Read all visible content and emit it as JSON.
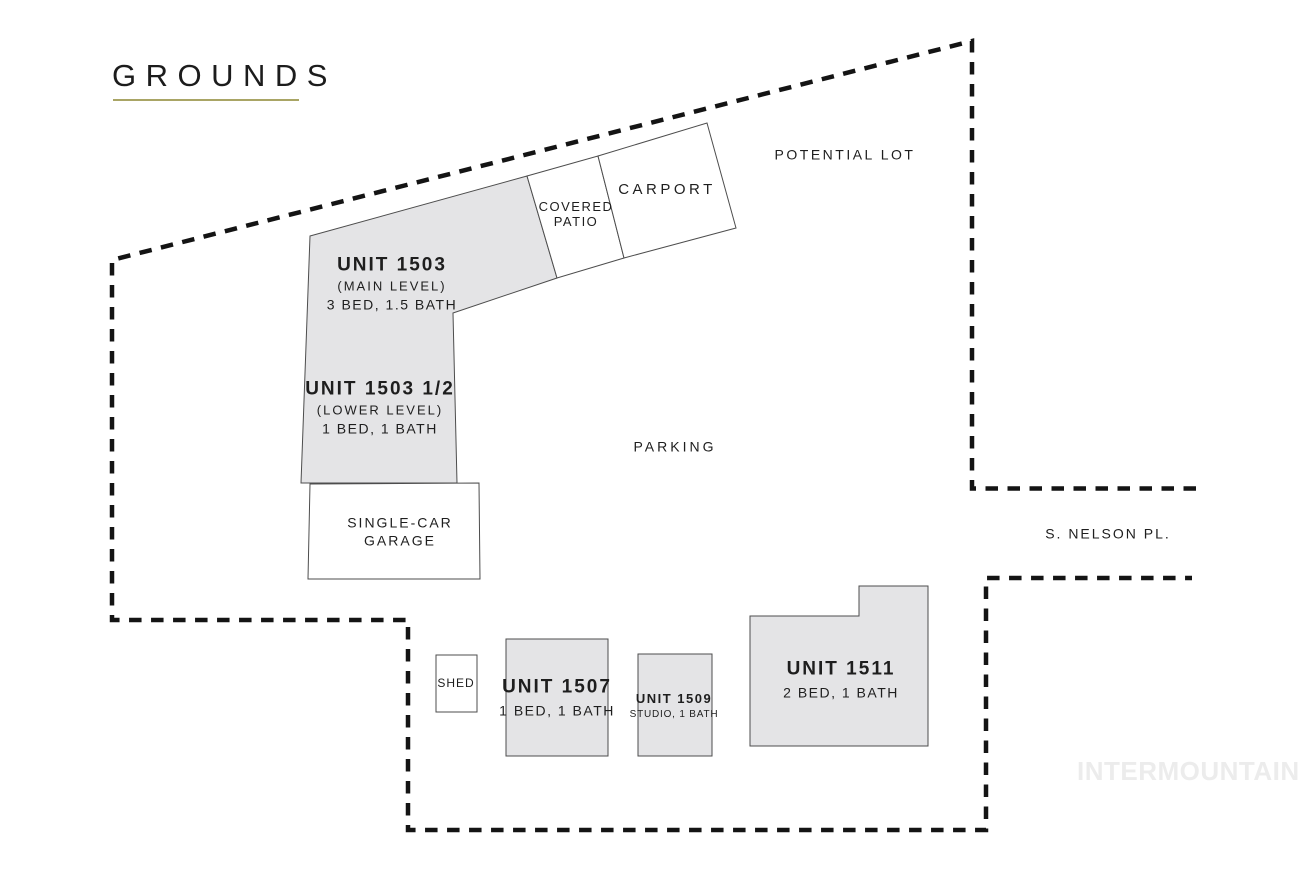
{
  "page": {
    "title": "GROUNDS",
    "watermark": "INTERMOUNTAIN"
  },
  "colors": {
    "background": "#ffffff",
    "building_fill": "#e4e4e6",
    "building_stroke": "#4d4d4d",
    "boundary_dash": "#141414",
    "title_underline": "#a9a565",
    "text": "#1e1e1e",
    "watermark": "#ececec"
  },
  "areas": {
    "potential_lot": "POTENTIAL LOT",
    "parking": "PARKING",
    "street": "S. NELSON PL."
  },
  "buildings": {
    "unit_1503": {
      "name": "UNIT 1503",
      "level": "(MAIN LEVEL)",
      "specs": "3 BED, 1.5 BATH"
    },
    "unit_1503_half": {
      "name": "UNIT 1503 1/2",
      "level": "(LOWER LEVEL)",
      "specs": "1 BED, 1 BATH"
    },
    "covered_patio": {
      "line1": "COVERED",
      "line2": "PATIO"
    },
    "carport": {
      "name": "CARPORT"
    },
    "garage": {
      "line1": "SINGLE-CAR",
      "line2": "GARAGE"
    },
    "shed": {
      "name": "SHED"
    },
    "unit_1507": {
      "name": "UNIT 1507",
      "specs": "1 BED, 1 BATH"
    },
    "unit_1509": {
      "name": "UNIT 1509",
      "specs": "STUDIO, 1 BATH"
    },
    "unit_1511": {
      "name": "UNIT 1511",
      "specs": "2 BED, 1 BATH"
    }
  }
}
